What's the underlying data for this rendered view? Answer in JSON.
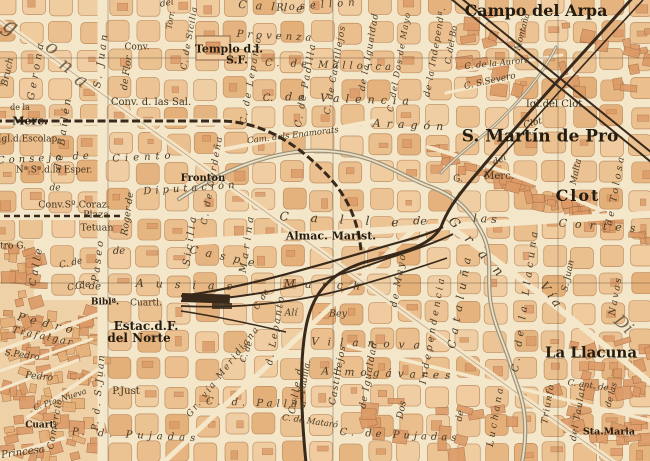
{
  "map": {
    "palette": {
      "paper": "#f4e6c9",
      "street": "#f5e7ca",
      "block_light": "#f0cb9e",
      "block_mid": "#ebbf8d",
      "block_dark": "#e4af78",
      "block_dense": "#dc9a67",
      "block_outline": "#bd8a5c",
      "dense_outline": "#a26c42",
      "rail": "#38291b",
      "water": "#98927e",
      "water_fill": "#efe0c2",
      "graticule": "#5c4c38",
      "label_ink": "#423420"
    },
    "towns": [
      "Campo del Arpa",
      "S. Martín de Pro",
      "Clot",
      "La Llacuna"
    ],
    "labels": [
      {
        "t": "Calle",
        "k": "street",
        "x": 275,
        "y": 7,
        "r": 4,
        "s": 11,
        "ls": 9,
        "i": 1
      },
      {
        "t": "del",
        "k": "street",
        "x": 167,
        "y": 4,
        "r": -10,
        "s": 9,
        "i": 1
      },
      {
        "t": "Rosellon",
        "k": "street",
        "x": 318,
        "y": 6,
        "r": -4,
        "s": 10,
        "ls": 5,
        "i": 1
      },
      {
        "t": "Campo del Arpa",
        "k": "town",
        "x": 536,
        "y": 11,
        "r": 0,
        "s": 16,
        "b": 1
      },
      {
        "t": "Conv.",
        "k": "poi",
        "x": 137,
        "y": 48,
        "r": 0,
        "s": 9
      },
      {
        "t": "Templo d.l.",
        "k": "poi",
        "x": 229,
        "y": 49,
        "r": 0,
        "s": 11,
        "b": 1
      },
      {
        "t": "S.F.",
        "k": "poi",
        "x": 237,
        "y": 60,
        "r": 0,
        "s": 11,
        "b": 1
      },
      {
        "t": "Provenza",
        "k": "street",
        "x": 276,
        "y": 37,
        "r": 3,
        "s": 10,
        "ls": 4,
        "i": 1
      },
      {
        "t": "Conv. d. las Sal.",
        "k": "poi",
        "x": 151,
        "y": 103,
        "r": 0,
        "s": 10
      },
      {
        "t": "de la",
        "k": "poi",
        "x": 20,
        "y": 108,
        "r": 0,
        "s": 8
      },
      {
        "t": "Merc.",
        "k": "poi",
        "x": 30,
        "y": 121,
        "r": 0,
        "s": 11,
        "b": 1
      },
      {
        "t": "Igl.d.Escolap.",
        "k": "poi",
        "x": 29,
        "y": 140,
        "r": 0,
        "s": 9
      },
      {
        "t": "Consejo de",
        "k": "street",
        "x": 45,
        "y": 159,
        "r": -3,
        "s": 10,
        "ls": 4,
        "i": 1
      },
      {
        "t": "Ciento",
        "k": "street",
        "x": 144,
        "y": 158,
        "r": -3,
        "s": 10,
        "ls": 5,
        "i": 1
      },
      {
        "t": "Nª.Sª.d.la Esper.",
        "k": "poi",
        "x": 54,
        "y": 171,
        "r": 0,
        "s": 9
      },
      {
        "t": "de",
        "k": "street",
        "x": 55,
        "y": 189,
        "r": 0,
        "s": 9,
        "i": 1
      },
      {
        "t": "Fronton",
        "k": "poi",
        "x": 203,
        "y": 179,
        "r": 0,
        "s": 10,
        "b": 1
      },
      {
        "t": "Diputación",
        "k": "street",
        "x": 191,
        "y": 189,
        "r": -4,
        "s": 10,
        "ls": 4,
        "i": 1
      },
      {
        "t": "Conv.Sº.Coraz.",
        "k": "poi",
        "x": 74,
        "y": 205,
        "r": 0,
        "s": 9.5
      },
      {
        "t": "Plaza",
        "k": "poi",
        "x": 96,
        "y": 215,
        "r": 0,
        "s": 9.5
      },
      {
        "t": "Tetuan",
        "k": "poi",
        "x": 97,
        "y": 228,
        "r": 0,
        "s": 9.5
      },
      {
        "t": "Calle",
        "k": "street",
        "x": 350,
        "y": 220,
        "r": 3,
        "s": 12,
        "ls": 22,
        "i": 1
      },
      {
        "t": "de",
        "k": "street",
        "x": 420,
        "y": 221,
        "r": 3,
        "s": 11,
        "i": 1
      },
      {
        "t": "las",
        "k": "street",
        "x": 487,
        "y": 219,
        "r": 3,
        "s": 11,
        "ls": 4,
        "i": 1
      },
      {
        "t": "Cortes",
        "k": "street",
        "x": 601,
        "y": 226,
        "r": 4,
        "s": 11,
        "ls": 8,
        "i": 1
      },
      {
        "t": "Almac. Marist.",
        "k": "poi",
        "x": 331,
        "y": 236,
        "r": 0,
        "s": 11,
        "b": 1
      },
      {
        "t": "Caspe",
        "k": "street",
        "x": 226,
        "y": 257,
        "r": 12,
        "s": 11,
        "ls": 8,
        "i": 1
      },
      {
        "t": "C. de",
        "k": "street",
        "x": 88,
        "y": 287,
        "r": 2,
        "s": 10,
        "i": 1
      },
      {
        "t": "Ausias",
        "k": "street",
        "x": 190,
        "y": 285,
        "r": 2,
        "s": 11,
        "ls": 12,
        "i": 1
      },
      {
        "t": "March",
        "k": "street",
        "x": 327,
        "y": 285,
        "r": 2,
        "s": 11,
        "ls": 10,
        "i": 1
      },
      {
        "t": "Biblª.",
        "k": "poi",
        "x": 105,
        "y": 303,
        "r": 0,
        "s": 9,
        "b": 1
      },
      {
        "t": "Cuartl.",
        "k": "poi",
        "x": 146,
        "y": 304,
        "r": 0,
        "s": 9
      },
      {
        "t": "Estac.d.F.",
        "k": "poi",
        "x": 146,
        "y": 326,
        "r": 0,
        "s": 12,
        "b": 1
      },
      {
        "t": "del Norte",
        "k": "poi",
        "x": 139,
        "y": 338,
        "r": 0,
        "s": 12,
        "b": 1
      },
      {
        "t": "P.Just",
        "k": "poi",
        "x": 126,
        "y": 392,
        "r": 0,
        "s": 10
      },
      {
        "t": "P. d. Pujadas",
        "k": "street",
        "x": 136,
        "y": 436,
        "r": 3,
        "s": 10,
        "ls": 5,
        "i": 1
      },
      {
        "t": "C. d. Pallás",
        "k": "street",
        "x": 258,
        "y": 404,
        "r": 2,
        "s": 10,
        "ls": 4,
        "i": 1
      },
      {
        "t": "C. de Mataró",
        "k": "street",
        "x": 310,
        "y": 422,
        "r": 8,
        "s": 8.5,
        "i": 1
      },
      {
        "t": "C. de Pujadas",
        "k": "street",
        "x": 400,
        "y": 436,
        "r": 3,
        "s": 10,
        "ls": 4,
        "i": 1
      },
      {
        "t": "Sta.Maria",
        "k": "poi",
        "x": 609,
        "y": 432,
        "r": 0,
        "s": 9.5,
        "b": 1
      },
      {
        "t": "La Llacuna",
        "k": "town",
        "x": 591,
        "y": 353,
        "r": 0,
        "s": 15,
        "b": 1
      },
      {
        "t": "S. Martín de Pro",
        "k": "town",
        "x": 540,
        "y": 137,
        "r": 0,
        "s": 17,
        "b": 1
      },
      {
        "t": "Clot",
        "k": "street",
        "x": 533,
        "y": 124,
        "r": -15,
        "s": 9,
        "i": 1
      },
      {
        "t": "Igl.del Clot",
        "k": "poi",
        "x": 554,
        "y": 105,
        "r": 0,
        "s": 10
      },
      {
        "t": "Clot",
        "k": "town",
        "x": 578,
        "y": 196,
        "r": 0,
        "s": 16,
        "b": 1,
        "ls": 2
      },
      {
        "t": "G.",
        "k": "poi",
        "x": 458,
        "y": 180,
        "r": 0,
        "s": 9
      },
      {
        "t": "Merc.",
        "k": "poi",
        "x": 499,
        "y": 177,
        "r": 0,
        "s": 10
      },
      {
        "t": "del",
        "k": "street",
        "x": 500,
        "y": 161,
        "r": -25,
        "s": 9,
        "i": 1
      },
      {
        "t": "C. de la Aurora",
        "k": "street",
        "x": 497,
        "y": 64,
        "r": -6,
        "s": 8.5,
        "i": 1
      },
      {
        "t": "C. S.Severo",
        "k": "street",
        "x": 490,
        "y": 82,
        "r": -12,
        "s": 9,
        "i": 1
      },
      {
        "t": "C. de Mallorca",
        "k": "street",
        "x": 330,
        "y": 66,
        "r": 2,
        "s": 10,
        "ls": 4,
        "i": 1
      },
      {
        "t": "de Valencia",
        "k": "street",
        "x": 350,
        "y": 99,
        "r": 2,
        "s": 11,
        "ls": 6,
        "i": 1
      },
      {
        "t": "C.",
        "k": "street",
        "x": 268,
        "y": 99,
        "r": 0,
        "s": 10,
        "i": 1
      },
      {
        "t": "Aragón",
        "k": "street",
        "x": 411,
        "y": 125,
        "r": 3,
        "s": 11,
        "ls": 6,
        "i": 1
      },
      {
        "t": "Cam. dels Enamorats",
        "k": "street",
        "x": 293,
        "y": 136,
        "r": -7,
        "s": 8.5,
        "i": 1
      },
      {
        "t": "Alí",
        "k": "street",
        "x": 291,
        "y": 313,
        "r": 0,
        "s": 9.5,
        "i": 1
      },
      {
        "t": "Bey",
        "k": "street",
        "x": 338,
        "y": 314,
        "r": 0,
        "s": 9.5,
        "i": 1
      },
      {
        "t": "Vilanova",
        "k": "street",
        "x": 370,
        "y": 344,
        "r": 2,
        "s": 10.5,
        "ls": 9,
        "i": 1
      },
      {
        "t": "Almogávares",
        "k": "street",
        "x": 389,
        "y": 374,
        "r": 2,
        "s": 10.5,
        "ls": 6,
        "i": 1
      },
      {
        "t": "Gr. vía Meridiana",
        "k": "street",
        "x": 224,
        "y": 372,
        "r": -52,
        "s": 9,
        "ls": 2,
        "i": 1
      },
      {
        "t": "Trafalgar",
        "k": "street",
        "x": 43,
        "y": 337,
        "r": 12,
        "s": 9.5,
        "ls": 2,
        "i": 1
      },
      {
        "t": "S.Pedro",
        "k": "street",
        "x": 22,
        "y": 356,
        "r": 8,
        "s": 9,
        "i": 1
      },
      {
        "t": "Pedro",
        "k": "street",
        "x": 39,
        "y": 377,
        "r": 6,
        "s": 9.5,
        "i": 1
      },
      {
        "t": "Pedro",
        "k": "street",
        "x": 48,
        "y": 324,
        "r": 14,
        "s": 11,
        "ls": 6,
        "i": 1
      },
      {
        "t": "Princesa",
        "k": "street",
        "x": 23,
        "y": 453,
        "r": -8,
        "s": 10,
        "i": 1
      },
      {
        "t": "Cuart.",
        "k": "poi",
        "x": 41,
        "y": 426,
        "r": 0,
        "s": 9,
        "b": 1
      },
      {
        "t": "C. Pta. Nueva",
        "k": "street",
        "x": 60,
        "y": 400,
        "r": -18,
        "s": 8,
        "i": 1
      },
      {
        "t": "tro G.",
        "k": "poi",
        "x": 13,
        "y": 247,
        "r": 0,
        "s": 9
      },
      {
        "t": "C. de",
        "k": "street",
        "x": 71,
        "y": 264,
        "r": -12,
        "s": 9,
        "i": 1
      },
      {
        "t": "C. de",
        "k": "street",
        "x": 79,
        "y": 287,
        "r": -10,
        "s": 9,
        "i": 1
      },
      {
        "t": "de",
        "k": "street",
        "x": 119,
        "y": 252,
        "r": 0,
        "s": 10,
        "i": 1
      },
      {
        "t": "C. ant. de",
        "k": "street",
        "x": 588,
        "y": 386,
        "r": 8,
        "s": 8.5,
        "i": 1
      },
      {
        "t": "Bruch",
        "k": "street",
        "x": 8,
        "y": 72,
        "r": -78,
        "s": 9.5,
        "i": 1
      },
      {
        "t": "Gerona",
        "k": "street",
        "x": 37,
        "y": 70,
        "r": -80,
        "s": 10,
        "ls": 4,
        "i": 1
      },
      {
        "t": "de Bailén",
        "k": "street",
        "x": 64,
        "y": 133,
        "r": -82,
        "s": 10,
        "ls": 3,
        "i": 1
      },
      {
        "t": "S. Juan",
        "k": "street",
        "x": 102,
        "y": 60,
        "r": -82,
        "s": 10,
        "ls": 3,
        "i": 1
      },
      {
        "t": "P. d. S.Juan",
        "k": "street",
        "x": 99,
        "y": 392,
        "r": -85,
        "s": 9.5,
        "ls": 2,
        "i": 1
      },
      {
        "t": "de Flor",
        "k": "street",
        "x": 127,
        "y": 73,
        "r": -82,
        "s": 9.5,
        "i": 1
      },
      {
        "t": "Roger de",
        "k": "street",
        "x": 128,
        "y": 214,
        "r": -82,
        "s": 9.5,
        "i": 1
      },
      {
        "t": "C. de Sicilia",
        "k": "street",
        "x": 190,
        "y": 38,
        "r": -80,
        "s": 8.5,
        "ls": 1,
        "i": 1
      },
      {
        "t": "Sicilia",
        "k": "street",
        "x": 191,
        "y": 240,
        "r": -82,
        "s": 10,
        "ls": 3,
        "i": 1
      },
      {
        "t": "C. de Cerdeña",
        "k": "street",
        "x": 213,
        "y": 180,
        "r": -80,
        "s": 9,
        "ls": 2,
        "i": 1
      },
      {
        "t": "Torr.",
        "k": "street",
        "x": 171,
        "y": 20,
        "r": -80,
        "s": 8,
        "i": 1
      },
      {
        "t": "Marina",
        "k": "street",
        "x": 248,
        "y": 243,
        "r": -82,
        "s": 10,
        "ls": 4,
        "i": 1
      },
      {
        "t": "C. de Lepanto",
        "k": "street",
        "x": 252,
        "y": 80,
        "r": -80,
        "s": 9,
        "ls": 2,
        "i": 1
      },
      {
        "t": "d. Lepanto",
        "k": "street",
        "x": 276,
        "y": 330,
        "r": -80,
        "s": 9.5,
        "ls": 2,
        "i": 1
      },
      {
        "t": "C. de Padilla",
        "k": "street",
        "x": 306,
        "y": 85,
        "r": -80,
        "s": 9.5,
        "ls": 2,
        "i": 1
      },
      {
        "t": "Padilla.",
        "k": "street",
        "x": 306,
        "y": 377,
        "r": -80,
        "s": 9,
        "i": 1
      },
      {
        "t": "C. de Castillejos",
        "k": "street",
        "x": 336,
        "y": 70,
        "r": -80,
        "s": 9,
        "ls": 1,
        "i": 1
      },
      {
        "t": "Castillejos",
        "k": "street",
        "x": 338,
        "y": 375,
        "r": -80,
        "s": 9.5,
        "ls": 1,
        "i": 1
      },
      {
        "t": "de la Igualdad",
        "k": "street",
        "x": 370,
        "y": 52,
        "r": -80,
        "s": 9,
        "ls": 1,
        "i": 1
      },
      {
        "t": "de Igualdad",
        "k": "street",
        "x": 369,
        "y": 375,
        "r": -80,
        "s": 9.5,
        "ls": 1,
        "i": 1
      },
      {
        "t": "C. del Dos de Mayo",
        "k": "street",
        "x": 400,
        "y": 62,
        "r": -80,
        "s": 8.5,
        "ls": 1,
        "i": 1
      },
      {
        "t": "de Mayo",
        "k": "street",
        "x": 399,
        "y": 280,
        "r": -80,
        "s": 9.5,
        "ls": 2,
        "i": 1
      },
      {
        "t": "Dos",
        "k": "street",
        "x": 402,
        "y": 410,
        "r": -80,
        "s": 9.5,
        "i": 1
      },
      {
        "t": "de la Independª.",
        "k": "street",
        "x": 436,
        "y": 52,
        "r": -80,
        "s": 9,
        "ls": 1,
        "i": 1
      },
      {
        "t": "Independencia",
        "k": "street",
        "x": 433,
        "y": 330,
        "r": -80,
        "s": 9.5,
        "ls": 3,
        "i": 1
      },
      {
        "t": "C. del Bo",
        "k": "street",
        "x": 452,
        "y": 45,
        "r": -80,
        "s": 8.5,
        "i": 1
      },
      {
        "t": "Montaña",
        "k": "street",
        "x": 523,
        "y": 32,
        "r": -75,
        "s": 8.5,
        "i": 1
      },
      {
        "t": "Cataluña",
        "k": "street",
        "x": 460,
        "y": 300,
        "r": -80,
        "s": 11,
        "ls": 6,
        "i": 1
      },
      {
        "t": "C. de la Llacuna",
        "k": "street",
        "x": 526,
        "y": 300,
        "r": -82,
        "s": 10,
        "ls": 4,
        "i": 1
      },
      {
        "t": "Malta",
        "k": "street",
        "x": 577,
        "y": 172,
        "r": -78,
        "s": 9,
        "i": 1
      },
      {
        "t": "S. Juan",
        "k": "street",
        "x": 569,
        "y": 276,
        "r": -78,
        "s": 9,
        "i": 1
      },
      {
        "t": "de Tolosa",
        "k": "street",
        "x": 616,
        "y": 190,
        "r": -80,
        "s": 9.5,
        "ls": 3,
        "i": 1
      },
      {
        "t": "Navas",
        "k": "street",
        "x": 616,
        "y": 296,
        "r": -80,
        "s": 9.5,
        "ls": 2,
        "i": 1
      },
      {
        "t": "de las",
        "k": "street",
        "x": 612,
        "y": 395,
        "r": -75,
        "s": 8.5,
        "i": 1
      },
      {
        "t": "del Taulat",
        "k": "street",
        "x": 579,
        "y": 414,
        "r": -80,
        "s": 9,
        "ls": 1,
        "i": 1
      },
      {
        "t": "Triunfo",
        "k": "street",
        "x": 549,
        "y": 404,
        "r": -80,
        "s": 9,
        "ls": 1,
        "i": 1
      },
      {
        "t": "Luchana",
        "k": "street",
        "x": 496,
        "y": 416,
        "r": -80,
        "s": 9.5,
        "ls": 3,
        "i": 1
      },
      {
        "t": "de",
        "k": "street",
        "x": 461,
        "y": 416,
        "r": -80,
        "s": 9,
        "i": 1
      },
      {
        "t": "Comercio",
        "k": "street",
        "x": 56,
        "y": 424,
        "r": -80,
        "s": 9,
        "ls": 1,
        "i": 1
      },
      {
        "t": "Calle",
        "k": "street",
        "x": 37,
        "y": 266,
        "r": -80,
        "s": 10,
        "ls": 3,
        "i": 1
      },
      {
        "t": "Paseo",
        "k": "street",
        "x": 99,
        "y": 260,
        "r": -83,
        "s": 10,
        "ls": 3,
        "i": 1
      },
      {
        "t": "Calle d.",
        "k": "street",
        "x": 297,
        "y": 388,
        "r": -80,
        "s": 9.5,
        "ls": 2,
        "i": 1
      },
      {
        "t": "C. de",
        "k": "street",
        "x": 262,
        "y": 300,
        "r": -60,
        "s": 8.5,
        "i": 1
      },
      {
        "t": "C. de",
        "k": "street",
        "x": 247,
        "y": 352,
        "r": -70,
        "s": 8.5,
        "i": 1
      },
      {
        "t": "Gran",
        "k": "street",
        "x": 480,
        "y": 252,
        "r": 48,
        "s": 13,
        "ls": 14,
        "i": 1
      },
      {
        "t": "Vía",
        "k": "street",
        "x": 552,
        "y": 296,
        "r": 55,
        "s": 12,
        "ls": 4,
        "i": 1
      },
      {
        "t": "g",
        "k": "ghost",
        "x": 10,
        "y": 27,
        "r": 30,
        "s": 22,
        "g": 1
      },
      {
        "t": "o",
        "k": "ghost",
        "x": 52,
        "y": 48,
        "r": 35,
        "s": 19,
        "g": 1
      },
      {
        "t": "n",
        "k": "ghost",
        "x": 66,
        "y": 66,
        "r": 35,
        "s": 19,
        "g": 1
      },
      {
        "t": "a",
        "k": "ghost",
        "x": 81,
        "y": 81,
        "r": 35,
        "s": 19,
        "g": 1
      },
      {
        "t": "Di",
        "k": "ghost",
        "x": 623,
        "y": 325,
        "r": 42,
        "s": 17,
        "g": 1
      }
    ]
  }
}
